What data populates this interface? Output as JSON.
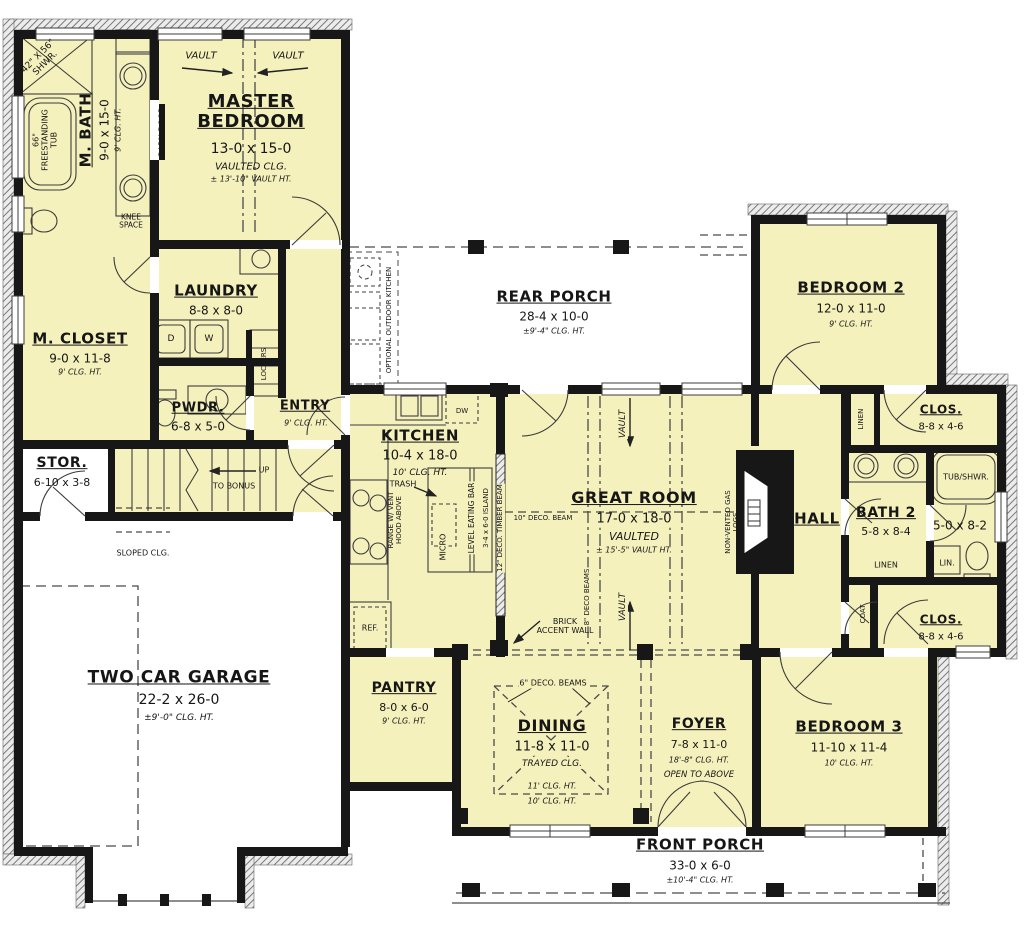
{
  "plan": {
    "title": "First floor plan",
    "colors": {
      "room_fill": "#f5f1bd",
      "wall": "#171717",
      "porch_fill": "#ffffff",
      "hatch": "#787878"
    },
    "rooms": {
      "master_bedroom": {
        "name": "MASTER BEDROOM",
        "dims": "13-0 x 15-0",
        "note1": "VAULTED CLG.",
        "note2": "± 13'-10\" VAULT HT."
      },
      "m_bath": {
        "name": "M. BATH",
        "dims": "9-0 x 15-0",
        "note1": "9' CLG. HT."
      },
      "m_closet": {
        "name": "M. CLOSET",
        "dims": "9-0 x 11-8",
        "note1": "9' CLG. HT."
      },
      "laundry": {
        "name": "LAUNDRY",
        "dims": "8-8 x 8-0"
      },
      "pwdr": {
        "name": "PWDR.",
        "dims": "6-8 x 5-0"
      },
      "entry": {
        "name": "ENTRY",
        "note1": "9' CLG. HT."
      },
      "stor": {
        "name": "STOR.",
        "dims": "6-10 x 3-8"
      },
      "garage": {
        "name": "TWO CAR GARAGE",
        "dims": "22-2 x 26-0",
        "note1": "±9'-0\" CLG. HT."
      },
      "rear_porch": {
        "name": "REAR PORCH",
        "dims": "28-4 x 10-0",
        "note1": "±9'-4\" CLG. HT."
      },
      "kitchen": {
        "name": "KITCHEN",
        "dims": "10-4 x 18-0",
        "note1": "10' CLG. HT."
      },
      "great_room": {
        "name": "GREAT ROOM",
        "dims": "17-0 x 18-0",
        "note1": "VAULTED",
        "note2": "± 15'-5\" VAULT HT."
      },
      "hall": {
        "name": "HALL"
      },
      "bedroom2": {
        "name": "BEDROOM 2",
        "dims": "12-0 x 11-0",
        "note1": "9' CLG. HT."
      },
      "clos_bed2": {
        "name": "CLOS.",
        "dims": "8-8 x 4-6"
      },
      "bath2": {
        "name": "BATH 2",
        "dims": "5-8 x 8-4"
      },
      "bath3": {
        "dims": "5-0 x 8-2"
      },
      "clos_bed3": {
        "name": "CLOS.",
        "dims": "8-8 x 4-6"
      },
      "bedroom3": {
        "name": "BEDROOM 3",
        "dims": "11-10 x 11-4",
        "note1": "10' CLG. HT."
      },
      "pantry": {
        "name": "PANTRY",
        "dims": "8-0 x 6-0",
        "note1": "9' CLG. HT."
      },
      "dining": {
        "name": "DINING",
        "dims": "11-8 x 11-0",
        "note1": "TRAYED CLG.",
        "note2": "11' CLG. HT.",
        "note3": "10' CLG. HT."
      },
      "foyer": {
        "name": "FOYER",
        "dims": "7-8 x 11-0",
        "note1": "18'-8\" CLG. HT.",
        "note2": "OPEN TO ABOVE"
      },
      "front_porch": {
        "name": "FRONT PORCH",
        "dims": "33-0 x 6-0",
        "note1": "±10'-4\" CLG. HT."
      }
    },
    "annotations": {
      "vault": "VAULT",
      "lin": "LIN.",
      "linen": "LINEN",
      "coat": "COAT",
      "lockers": "LOCKERS",
      "barn_door": "BARN DOOR",
      "knee_space": "KNEE SPACE",
      "shower": "42\" X 56\" SHWR.",
      "tub": "66\" FREESTANDING TUB",
      "outdoor_kitchen": "OPTIONAL OUTDOOR KITCHEN",
      "dw": "DW",
      "d": "D",
      "w": "W",
      "ref": "REF.",
      "micro": "MICRO",
      "trash": "TRASH",
      "range_hood": "RANGE W/ VENT HOOD ABOVE",
      "eating_bar": "LEVEL EATING BAR",
      "island": "3-4 x 6-0 ISLAND",
      "timber_beam": "12\" DECO. TIMBER BEAM",
      "deco_beam_10": "10\" DECO. BEAM",
      "deco_beams_8": "8\" DECO BEAMS",
      "deco_beams_6": "6\" DECO. BEAMS",
      "brick_accent": "BRICK ACCENT WALL",
      "gas_logs": "NON-VENTED GAS LOGS",
      "up": "UP",
      "to_bonus": "TO BONUS",
      "sloped_clg": "SLOPED CLG.",
      "tub_shwr": "TUB/SHWR."
    }
  }
}
